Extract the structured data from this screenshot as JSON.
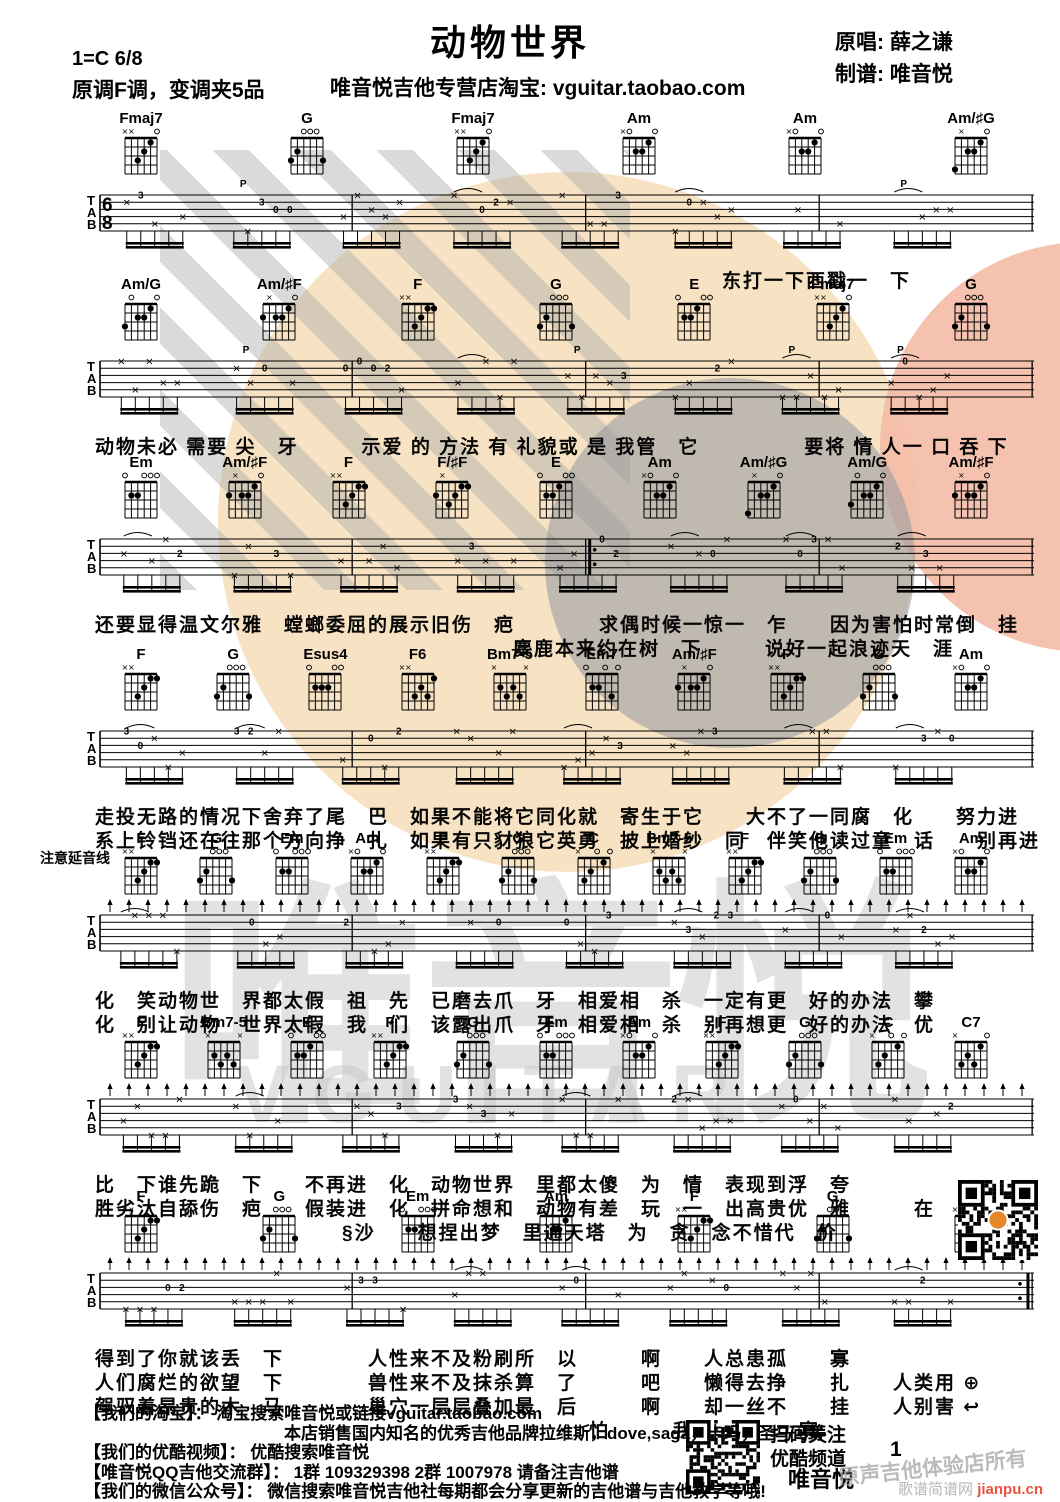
{
  "header": {
    "title": "动物世界",
    "key": "1=C 6/8",
    "capo": "原调F调，变调夹5品",
    "store": "唯音悦吉他专营店淘宝: vguitar.taobao.com",
    "singer": "原唱: 薛之谦",
    "arranger": "制谱: 唯音悦"
  },
  "note_left": "注意延音线",
  "chord_shapes": {
    "Fmaj7": "xx3210",
    "G": "320003",
    "Am": "x02210",
    "Am/♯G": "4x2210",
    "Am/G": "302210",
    "Am/♯F": "2x2210",
    "F": "xx3211",
    "E": "022100",
    "Em": "022000",
    "Em7": "022030",
    "Esus4": "022200",
    "F6": "xx3231",
    "F/♯F": "2x3211",
    "Bm7-5": "x2323x",
    "C": "x32010",
    "C7": "x32310"
  },
  "rows": [
    {
      "time_sig": "6/8",
      "chords": [
        "Fmaj7",
        "G",
        "Fmaj7",
        "Am",
        "Am",
        "Am/♯G"
      ],
      "lyrics": [
        {
          "indent": 33,
          "text": "东打一下西戳一　下"
        }
      ]
    },
    {
      "chords": [
        "Am/G",
        "Am/♯F",
        "F",
        "G",
        "E",
        "Fmaj7",
        "G"
      ],
      "lyrics": [
        {
          "indent": 0,
          "text": "动物未必 需要 尖　牙　　　示爱 的 方法 有 礼貌或 是 我管　它　　　　　要将 情 人一 口 吞 下"
        }
      ]
    },
    {
      "chords": [
        "Em",
        "Am/♯F",
        "F",
        "F/♯F",
        "E",
        "Am",
        "Am/♯G",
        "Am/G",
        "Am/♯F"
      ],
      "lyrics": [
        {
          "indent": 0,
          "text": "还要显得温文尔雅　螳螂委屈的展示旧伤　疤　　　　求偶时候一惊一　乍　　因为害怕时常倒　挂"
        },
        {
          "indent": 22,
          "text": "麋鹿本来约在树　下　　　说好一起浪迹天　涯"
        }
      ]
    },
    {
      "chords": [
        "F",
        "G",
        "Esus4",
        "F6",
        "Bm7-5",
        "Em7",
        "Am/♯F",
        "F",
        "G",
        "Am"
      ],
      "lyrics": [
        {
          "indent": 0,
          "text": "走投无路的情况下舍弃了尾　巴　如果不能将它同化就　寄生于它　　大不了一同腐　化　　努力进"
        },
        {
          "indent": 0,
          "text": "系上铃铛还在往那个方向挣　扎　如果有只豺狼它英勇　披上婚纱　同　伴笑他读过童　话　　别再进"
        }
      ]
    },
    {
      "chords": [
        "F",
        "G",
        "Em",
        "Am",
        "F",
        "G",
        "C",
        "Bm7-5",
        "F",
        "G",
        "Em",
        "Am"
      ],
      "lyrics": [
        {
          "indent": 0,
          "text": "化　笑动物世　界都太假　祖　先　已磨去爪　牙　相爱相　杀　一定有更　好的办法　攀"
        },
        {
          "indent": 0,
          "text": "化　别让动物　世界太假　我　们　该露出爪　牙　相爱相　杀　别再想更　好的办法　优"
        }
      ]
    },
    {
      "chords": [
        "F",
        "Bm7-5",
        "E",
        "F",
        "G",
        "Em",
        "Am",
        "F",
        "G",
        "C",
        "C7"
      ],
      "lyrics": [
        {
          "indent": 0,
          "text": "比　下谁先跪　下　　不再进　化　动物世界　里都太傻　为　情　表现到浮　夸"
        },
        {
          "indent": 0,
          "text": "胜劣汰自舔伤　疤　　假装进　化　拼命想和　动物有差　玩　一　出高贵优　雅　　　在"
        },
        {
          "indent": 13,
          "text": "§沙　　想捏出梦　里通天塔　为　贪　念不惜代　价"
        }
      ]
    },
    {
      "chords": [
        "F",
        "G",
        "Em",
        "Am",
        "F",
        "G",
        "Am"
      ],
      "lyrics": [
        {
          "indent": 0,
          "text": "得到了你就该丢　下　　　　人性来不及粉刷所　以　　　啊　　人总患孤　　寡"
        },
        {
          "indent": 0,
          "text": "人们腐烂的欲望　下　　　　兽性来不及抹杀算　了　　　吧　　懒得去挣　　扎　　人类用 ⊕"
        },
        {
          "indent": 0,
          "text": "驾驭着昂贵的木　马　　　　巢穴一层层叠加最　后　　　啊　　却一丝不　　挂　　人别害 ↩"
        },
        {
          "indent": 26,
          "text": "怕　　　我们都孤　　寡"
        }
      ]
    }
  ],
  "footer": {
    "lines": [
      "【我们的淘宝】：  淘宝搜索唯音悦或链接vguitar.taobao.com",
      "本店销售国内知名的优秀吉他品牌拉维斯，dove,saga，卡玛，圣马可等",
      "【我们的优酷视频】：  优酷搜索唯音悦",
      "【唯音悦QQ吉他交流群】：  1群 109329398 2群 1007978 请备注吉他谱",
      "【我们的微信公众号】：  微信搜索唯音悦吉他社每期都会分享更新的吉他谱与吉他教学等哦!"
    ],
    "scan_note": "扫码关注\n优酷频道",
    "brand": "唯音悦",
    "page": "1",
    "shop_watermark": "原声吉他体验店所有",
    "site_watermark": "歌谱简谱网",
    "site_url": "jianpu.cn"
  },
  "watermark": {
    "big_text": "唯音悦",
    "sub_text": "VGUITAR"
  },
  "colors": {
    "peach_circle": "#f7e3c3",
    "salmon_circle": "#f3bba6",
    "grey_logo": "#c6c6c8",
    "site_red": "#e8553f",
    "ink": "#000000"
  }
}
